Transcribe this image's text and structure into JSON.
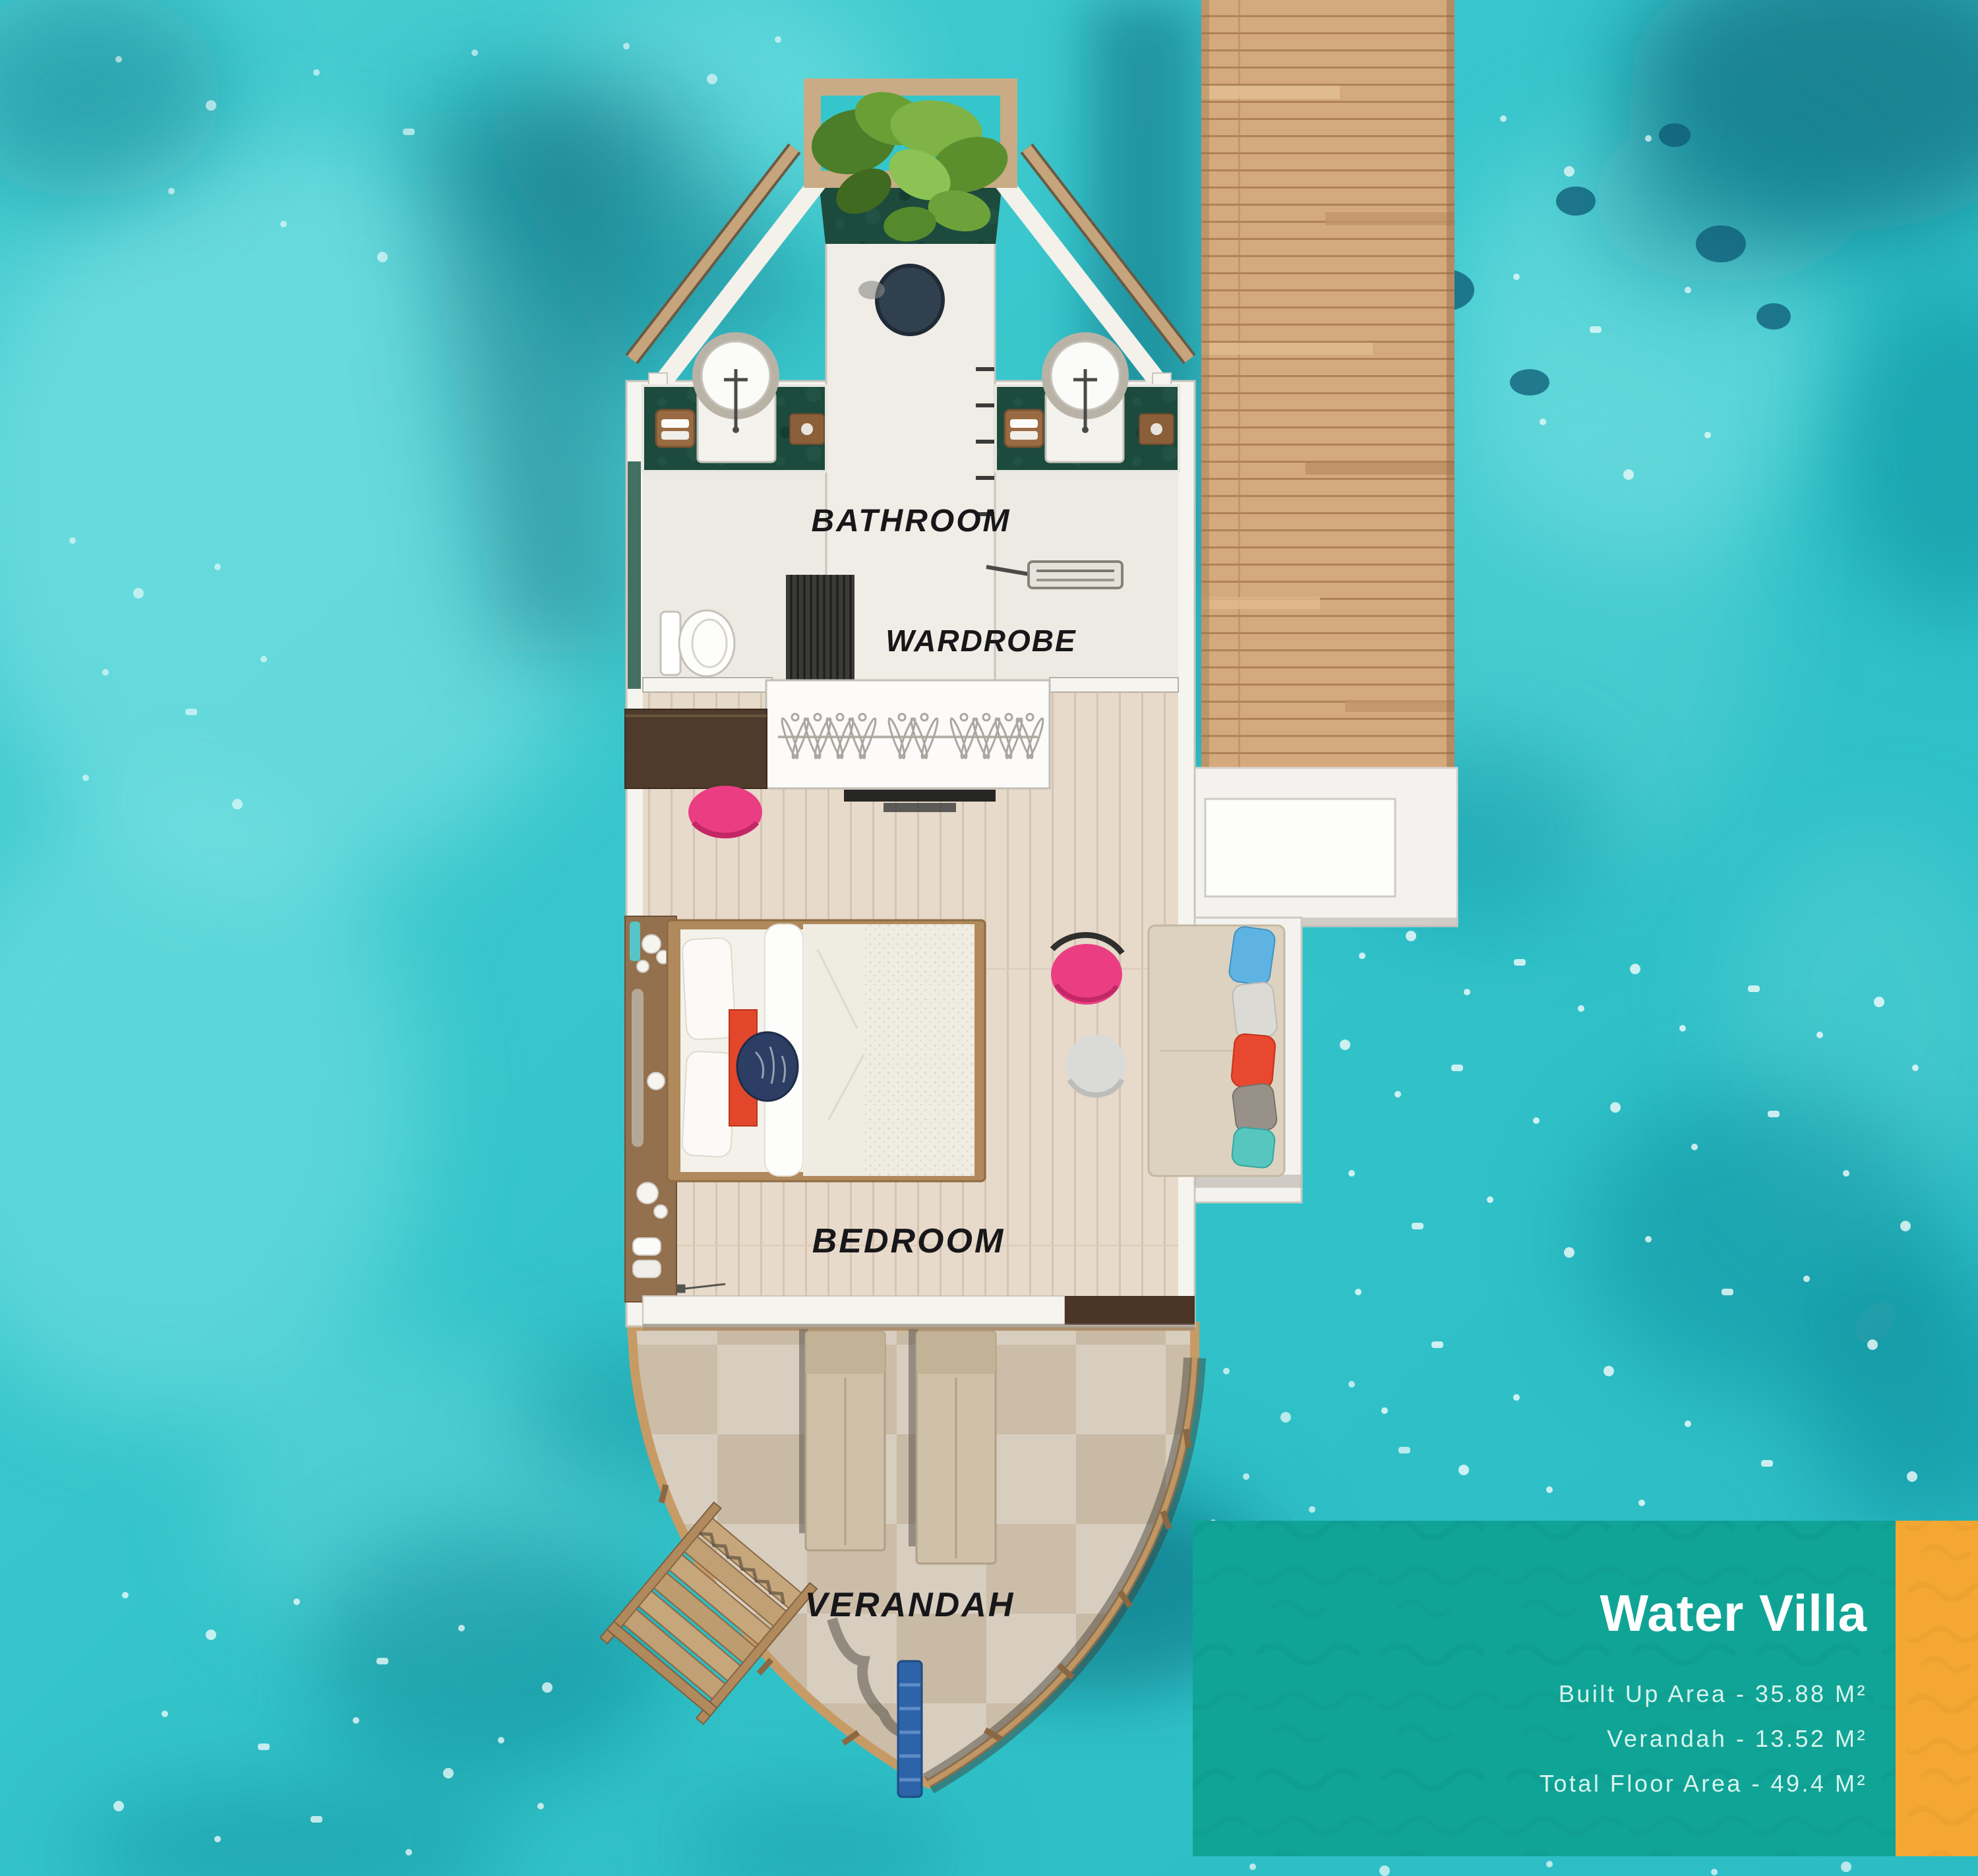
{
  "rooms": {
    "bathroom": "BATHROOM",
    "wardrobe": "WARDROBE",
    "bedroom": "BEDROOM",
    "verandah": "VERANDAH"
  },
  "info_card": {
    "title": "Water Villa",
    "details": [
      "Built Up Area - 35.88 M²",
      "Verandah - 13.52 M²",
      "Total Floor Area - 49.4 M²"
    ]
  },
  "palette": {
    "water": "#35c6cb",
    "water_light": "#8beaea",
    "water_dark": "#0e8292",
    "water_deep": "#0a6a7c",
    "jetty_wood": "#d4aa7d",
    "villa_wall": "#f6f4ef",
    "bathroom_floor": "#edeae3",
    "wood_floor": "#e7dacb",
    "verandah_floor": "#d8cec0",
    "marble_green": "#1c4a3d",
    "accent_pink": "#ea3d82",
    "accent_red": "#e2472c",
    "navy_pillow": "#2c3e63",
    "card_teal": "#10a496",
    "card_orange": "#f4a833",
    "label_color": "#17171a"
  }
}
